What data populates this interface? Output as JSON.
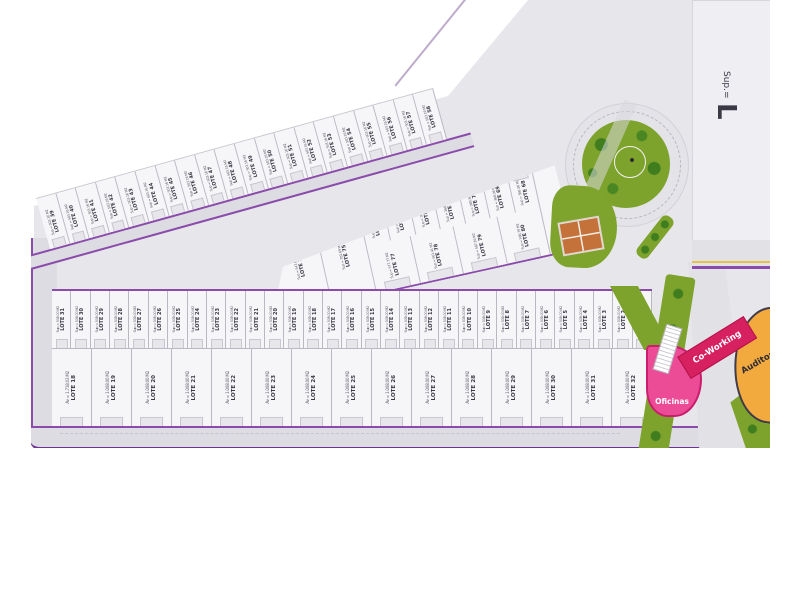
{
  "colors": {
    "road_edge_purple": "#8a4bab",
    "road_fill": "#dddce2",
    "plan_ground": "#e7e6eb",
    "lot_fill": "#f6f5f8",
    "green": "#7da32c",
    "tree_green": "#3f7d1f",
    "oficinas_pink": "#ec4b95",
    "coworking_crimson": "#d6205f",
    "auditorio_orange": "#f2a93d",
    "tennis_court": "#c4713a",
    "yellow_line": "#e5c24c"
  },
  "top_band": {
    "lots": [
      {
        "label": "LOTE 39",
        "sup": "Sup = 503.16 M2"
      },
      {
        "label": "LOTE 40",
        "sup": "Sup = 503.16 M2"
      },
      {
        "label": "LOTE 41",
        "sup": "Sup = 503.16 M2"
      },
      {
        "label": "LOTE 42",
        "sup": "Sup = 503.16 M2"
      },
      {
        "label": "LOTE 43",
        "sup": "Sup = 503.16 M2"
      },
      {
        "label": "LOTE 44",
        "sup": "Sup = 503.16 M2"
      },
      {
        "label": "LOTE 45",
        "sup": "Sup = 503.16 M2"
      },
      {
        "label": "LOTE 46",
        "sup": "Sup = 503.16 M2"
      },
      {
        "label": "LOTE 47",
        "sup": "Sup = 503.16 M2"
      },
      {
        "label": "LOTE 48",
        "sup": "Sup = 503.16 M2"
      },
      {
        "label": "LOTE 49",
        "sup": "Sup = 503.16 M2"
      },
      {
        "label": "LOTE 50",
        "sup": "Sup = 503.16 M2"
      },
      {
        "label": "LOTE 51",
        "sup": "Sup = 503.16 M2"
      },
      {
        "label": "LOTE 52",
        "sup": "Sup = 503.16 M2"
      },
      {
        "label": "LOTE 53",
        "sup": "Sup = 503.16 M2"
      },
      {
        "label": "LOTE 54",
        "sup": "Sup = 503.16 M2"
      },
      {
        "label": "LOTE 55",
        "sup": "Sup = 503.16 M2"
      },
      {
        "label": "LOTE 56",
        "sup": "Sup = 503.16 M2"
      },
      {
        "label": "LOTE 57",
        "sup": "Sup = 503.16 M2"
      },
      {
        "label": "LOTE 58",
        "sup": "Sup = 503.16 M2"
      }
    ]
  },
  "wedge": {
    "left_lots": [
      {
        "label": "LOTE 76",
        "sup": "Sup = 547.63 M2"
      },
      {
        "label": "LOTE 75",
        "sup": "Sup = 702.69 M2"
      }
    ],
    "small_lots": [
      {
        "label": "LOTE 74",
        "sup": "Sup = 360.36 M2"
      },
      {
        "label": "LOTE 73",
        "sup": "Sup = 360.36 M2"
      },
      {
        "label": "LOTE 72",
        "sup": "Sup = 360.36 M2"
      },
      {
        "label": "LOTE 71",
        "sup": "Sup = 360.36 M2"
      },
      {
        "label": "LOTE 70",
        "sup": "Sup = 360.36 M2"
      },
      {
        "label": "LOTE 69",
        "sup": "Sup = 360.36 M2"
      },
      {
        "label": "LOTE 68",
        "sup": "Sup = 360.36 M2"
      }
    ],
    "bottom_lots": [
      {
        "label": "LOTE 77",
        "sup": "Sup = 577.77 M2"
      },
      {
        "label": "LOTE 78",
        "sup": "Sup = 561.41 M2"
      },
      {
        "label": "LOTE 79",
        "sup": "Sup = 567.26 M2"
      },
      {
        "label": "LOTE 80",
        "sup": "Sup = 566.79 M2"
      }
    ]
  },
  "central": {
    "upper_lots": [
      {
        "label": "LOTE 31",
        "sup": "Sup = 508.00 M2"
      },
      {
        "label": "LOTE 30",
        "sup": "Sup = 508.00 M2"
      },
      {
        "label": "LOTE 29",
        "sup": "Sup = 508.00 M2"
      },
      {
        "label": "LOTE 28",
        "sup": "Sup = 508.00 M2"
      },
      {
        "label": "LOTE 27",
        "sup": "Sup = 508.00 M2"
      },
      {
        "label": "LOTE 26",
        "sup": "Sup = 508.00 M2"
      },
      {
        "label": "LOTE 25",
        "sup": "Sup = 508.00 M2"
      },
      {
        "label": "LOTE 24",
        "sup": "Sup = 508.00 M2"
      },
      {
        "label": "LOTE 23",
        "sup": "Sup = 508.00 M2"
      },
      {
        "label": "LOTE 22",
        "sup": "Sup = 508.00 M2"
      },
      {
        "label": "LOTE 21",
        "sup": "Sup = 508.00 M2"
      },
      {
        "label": "LOTE 20",
        "sup": "Sup = 508.00 M2"
      },
      {
        "label": "LOTE 19",
        "sup": "Sup = 508.00 M2"
      },
      {
        "label": "LOTE 18",
        "sup": "Sup = 508.00 M2"
      },
      {
        "label": "LOTE 17",
        "sup": "Sup = 508.00 M2"
      },
      {
        "label": "LOTE 16",
        "sup": "Sup = 508.00 M2"
      },
      {
        "label": "LOTE 15",
        "sup": "Sup = 508.00 M2"
      },
      {
        "label": "LOTE 14",
        "sup": "Sup = 508.00 M2"
      },
      {
        "label": "LOTE 13",
        "sup": "Sup = 508.00 M2"
      },
      {
        "label": "LOTE 12",
        "sup": "Sup = 508.00 M2"
      },
      {
        "label": "LOTE 11",
        "sup": "Sup = 508.00 M2"
      },
      {
        "label": "LOTE 10",
        "sup": "Sup = 508.00 M2"
      },
      {
        "label": "LOTE 9",
        "sup": "Sup = 508.00 M2"
      },
      {
        "label": "LOTE 8",
        "sup": "Sup = 508.00 M2"
      },
      {
        "label": "LOTE 7",
        "sup": "Sup = 508.00 M2"
      },
      {
        "label": "LOTE 6",
        "sup": "Sup = 508.00 M2"
      },
      {
        "label": "LOTE 5",
        "sup": "Sup = 508.00 M2"
      },
      {
        "label": "LOTE 4",
        "sup": "Sup = 508.00 M2"
      },
      {
        "label": "LOTE 3",
        "sup": "Sup = 508.00 M2"
      },
      {
        "label": "LOTE 2",
        "sup": "Sup = 508.00 M2"
      },
      {
        "label": "LOTE 1",
        "sup": "Sup = 508.00 M2"
      }
    ],
    "lower_lots": [
      {
        "label": "LOTE 18",
        "sup": "Av = 1.718.03 M2"
      },
      {
        "label": "LOTE 19",
        "sup": "Av = 1.008.00 M2"
      },
      {
        "label": "LOTE 20",
        "sup": "Av = 1.008.00 M2"
      },
      {
        "label": "LOTE 21",
        "sup": "Av = 1.008.00 M2"
      },
      {
        "label": "LOTE 22",
        "sup": "Av = 1.008.00 M2"
      },
      {
        "label": "LOTE 23",
        "sup": "Av = 1.008.00 M2"
      },
      {
        "label": "LOTE 24",
        "sup": "Av = 1.008.00 M2"
      },
      {
        "label": "LOTE 25",
        "sup": "Av = 1.008.00 M2"
      },
      {
        "label": "LOTE 26",
        "sup": "Av = 1.008.00 M2"
      },
      {
        "label": "LOTE 27",
        "sup": "Av = 1.008.00 M2"
      },
      {
        "label": "LOTE 28",
        "sup": "Av = 1.008.00 M2"
      },
      {
        "label": "LOTE 29",
        "sup": "Av = 1.008.00 M2"
      },
      {
        "label": "LOTE 30",
        "sup": "Av = 1.008.00 M2"
      },
      {
        "label": "LOTE 31",
        "sup": "Av = 1.008.00 M2"
      },
      {
        "label": "LOTE 32",
        "sup": "Av = 1.008.00 M2"
      }
    ]
  },
  "amenities": {
    "oficinas": "Oficinas",
    "coworking": "Co-Working",
    "auditorio": "Auditorio"
  },
  "right_block": {
    "sup": "Sup.=",
    "big_letter": "L"
  }
}
